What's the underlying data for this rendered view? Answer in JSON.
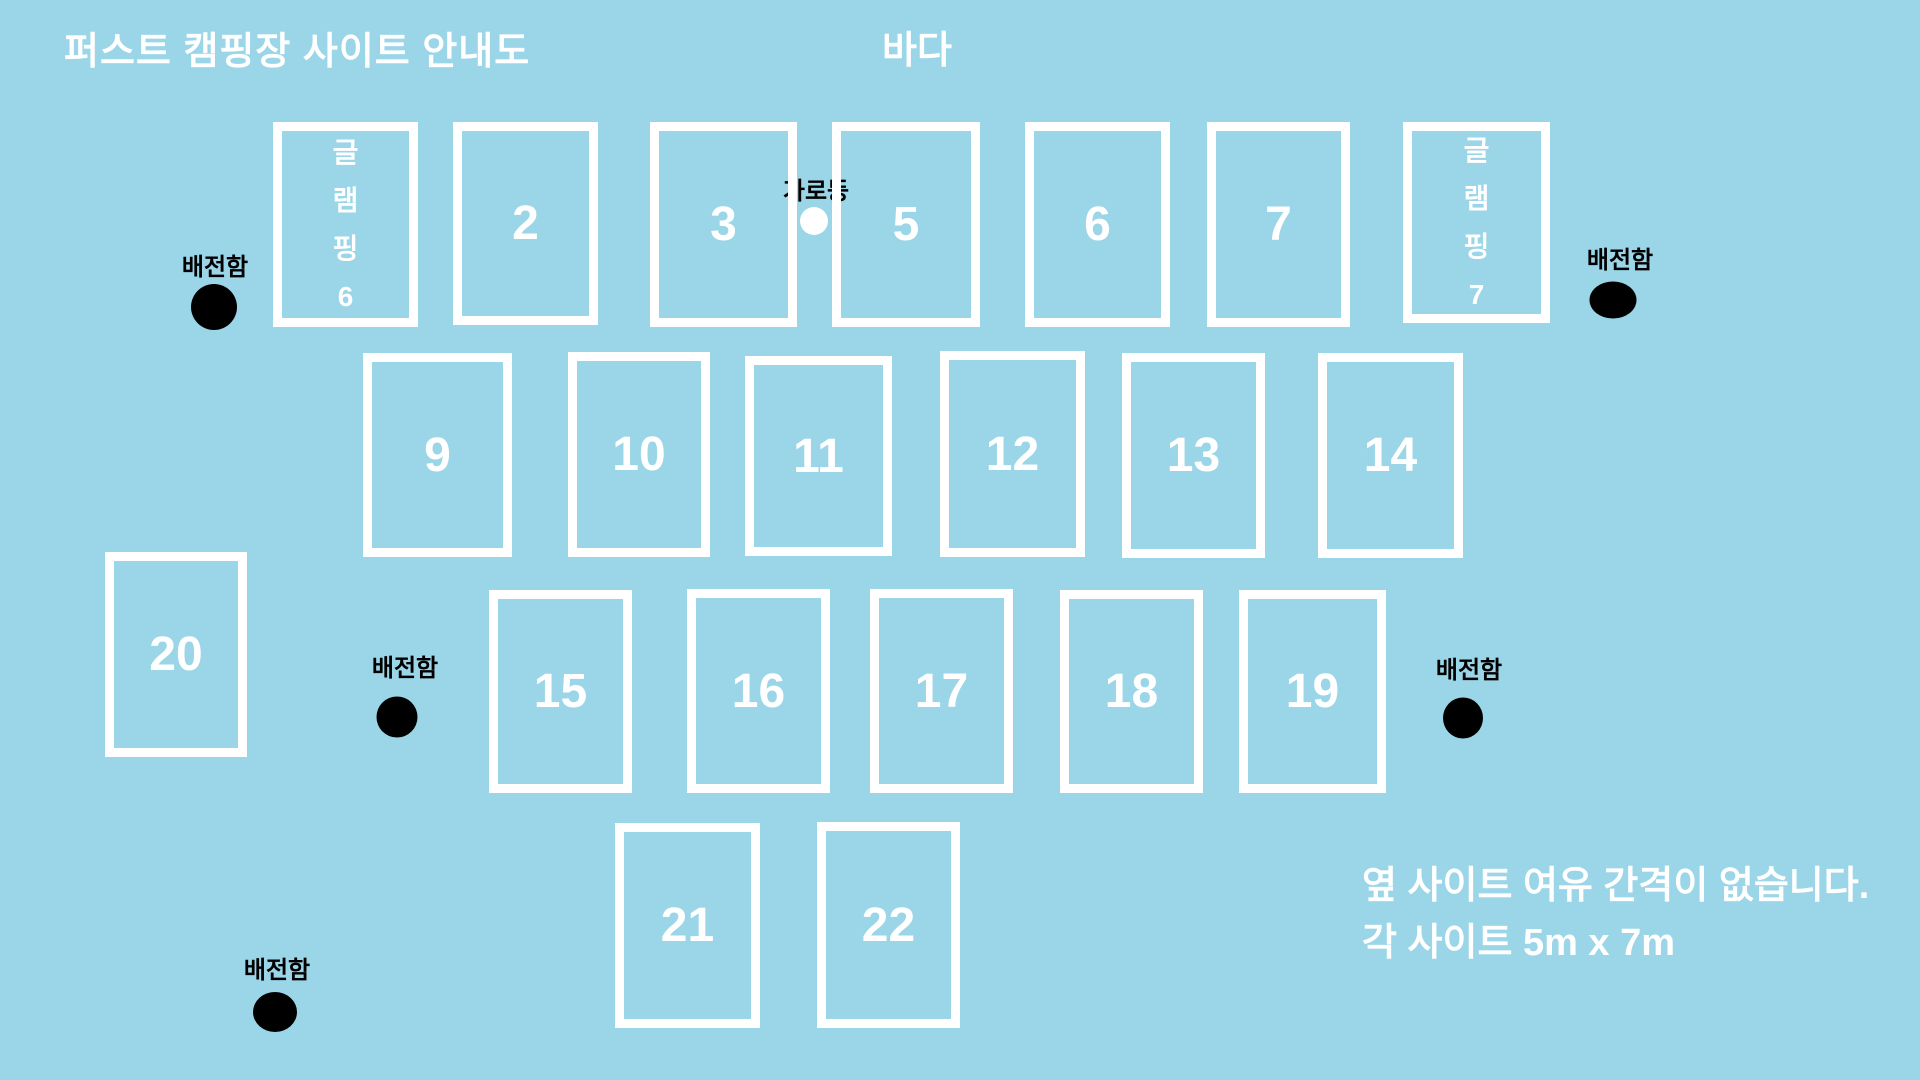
{
  "title": "퍼스트 캠핑장 사이트 안내도",
  "sea_label": "바다",
  "street_light": {
    "label": "가로등",
    "cx": 816,
    "label_top": 171,
    "dot_cx": 814,
    "dot_cy": 221,
    "dot_d": 28
  },
  "notes": {
    "line1": "옆 사이트 여유 간격이 없습니다.",
    "line2": "각 사이트 5m x 7m"
  },
  "colors": {
    "background": "#9ad5e8",
    "site_border": "#ffffff",
    "site_text": "#ffffff",
    "label_text": "#000000",
    "power_dot": "#000000",
    "street_light_dot": "#ffffff"
  },
  "sites": [
    {
      "id": "glamping-6",
      "chars": [
        "글",
        "램",
        "핑",
        "6"
      ],
      "x": 273,
      "y": 122,
      "w": 145,
      "h": 205
    },
    {
      "id": "2",
      "label": "2",
      "x": 453,
      "y": 122,
      "w": 145,
      "h": 203
    },
    {
      "id": "3",
      "label": "3",
      "x": 650,
      "y": 122,
      "w": 147,
      "h": 205
    },
    {
      "id": "5",
      "label": "5",
      "x": 832,
      "y": 122,
      "w": 148,
      "h": 205
    },
    {
      "id": "6",
      "label": "6",
      "x": 1025,
      "y": 122,
      "w": 145,
      "h": 205
    },
    {
      "id": "7",
      "label": "7",
      "x": 1207,
      "y": 122,
      "w": 143,
      "h": 205
    },
    {
      "id": "glamping-7",
      "chars": [
        "글",
        "램",
        "핑",
        "7"
      ],
      "x": 1403,
      "y": 122,
      "w": 147,
      "h": 201
    },
    {
      "id": "9",
      "label": "9",
      "x": 363,
      "y": 353,
      "w": 149,
      "h": 204
    },
    {
      "id": "10",
      "label": "10",
      "x": 568,
      "y": 352,
      "w": 142,
      "h": 205
    },
    {
      "id": "11",
      "label": "11",
      "x": 745,
      "y": 356,
      "w": 147,
      "h": 200
    },
    {
      "id": "12",
      "label": "12",
      "x": 940,
      "y": 351,
      "w": 145,
      "h": 206
    },
    {
      "id": "13",
      "label": "13",
      "x": 1122,
      "y": 353,
      "w": 143,
      "h": 205
    },
    {
      "id": "14",
      "label": "14",
      "x": 1318,
      "y": 353,
      "w": 145,
      "h": 205
    },
    {
      "id": "20",
      "label": "20",
      "x": 105,
      "y": 552,
      "w": 142,
      "h": 205
    },
    {
      "id": "15",
      "label": "15",
      "x": 489,
      "y": 590,
      "w": 143,
      "h": 203
    },
    {
      "id": "16",
      "label": "16",
      "x": 687,
      "y": 589,
      "w": 143,
      "h": 204
    },
    {
      "id": "17",
      "label": "17",
      "x": 870,
      "y": 589,
      "w": 143,
      "h": 204
    },
    {
      "id": "18",
      "label": "18",
      "x": 1060,
      "y": 590,
      "w": 143,
      "h": 203
    },
    {
      "id": "19",
      "label": "19",
      "x": 1239,
      "y": 590,
      "w": 147,
      "h": 203
    },
    {
      "id": "21",
      "label": "21",
      "x": 615,
      "y": 823,
      "w": 145,
      "h": 205
    },
    {
      "id": "22",
      "label": "22",
      "x": 817,
      "y": 822,
      "w": 143,
      "h": 206
    }
  ],
  "power_boxes": [
    {
      "label": "배전함",
      "cx": 215,
      "label_top": 247,
      "dot_cx": 214,
      "dot_cy": 307,
      "dot_w": 46,
      "dot_h": 46
    },
    {
      "label": "배전함",
      "cx": 1620,
      "label_top": 240,
      "dot_cx": 1613,
      "dot_cy": 300,
      "dot_w": 47,
      "dot_h": 37
    },
    {
      "label": "배전함",
      "cx": 405,
      "label_top": 648,
      "dot_cx": 397,
      "dot_cy": 717,
      "dot_w": 41,
      "dot_h": 41
    },
    {
      "label": "배전함",
      "cx": 1469,
      "label_top": 650,
      "dot_cx": 1463,
      "dot_cy": 718,
      "dot_w": 40,
      "dot_h": 41
    },
    {
      "label": "배전함",
      "cx": 277,
      "label_top": 950,
      "dot_cx": 275,
      "dot_cy": 1012,
      "dot_w": 44,
      "dot_h": 40
    }
  ]
}
